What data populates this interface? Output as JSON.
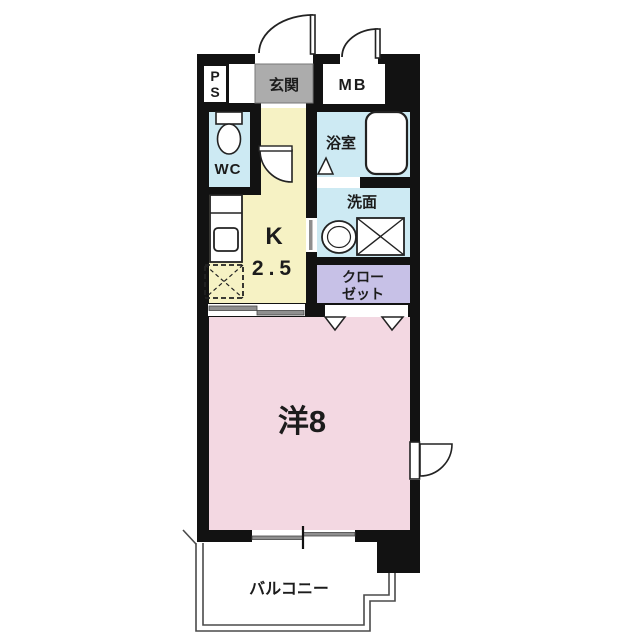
{
  "colors": {
    "wall": "#121212",
    "wet_blue": "#CDEAF3",
    "kitchen_yellow": "#F6F2C4",
    "closet_lavender": "#C7C1E7",
    "room_pink": "#F3D8E2",
    "entrance_gray": "#ACACAC",
    "slider_gray": "#8F8F8F"
  },
  "rooms": {
    "ps": {
      "line1": "P",
      "line2": "S"
    },
    "entrance": {
      "label": "玄関"
    },
    "meter_box": {
      "label": "MB"
    },
    "toilet": {
      "label": "WC"
    },
    "bathroom": {
      "label": "浴室"
    },
    "washroom": {
      "label": "洗面"
    },
    "kitchen": {
      "line1": "K",
      "line2": "2.5"
    },
    "closet": {
      "line1": "クロー",
      "line2": "ゼット"
    },
    "western_room": {
      "label": "洋8"
    },
    "balcony": {
      "label": "バルコニー"
    }
  }
}
